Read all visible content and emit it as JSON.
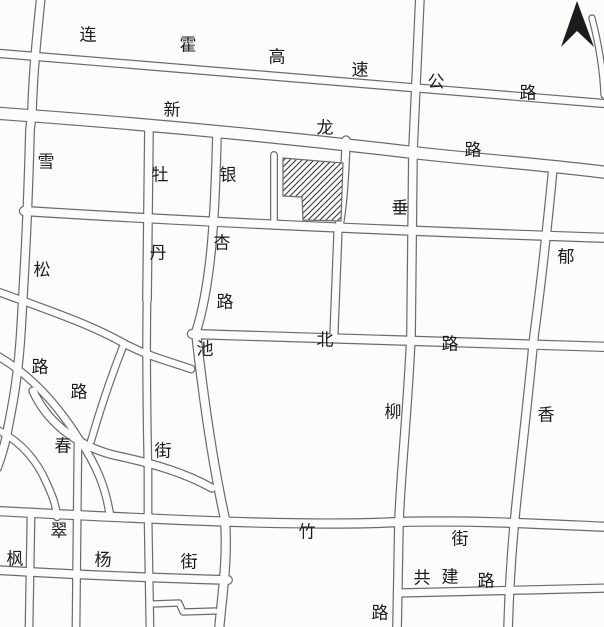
{
  "map": {
    "type": "scanned-planning-sketch",
    "colors": {
      "paper": "#fcfcfa",
      "line": "#6b6b6b",
      "ink": "#1c1c1c",
      "site_fill": "#fcfcfa",
      "hatch_line": "#3a3a3a"
    },
    "north_arrow": {
      "present": true
    },
    "site_marker": {
      "style": "diagonal-hatch-parcel",
      "notch": "bottom-left"
    },
    "roads": [
      {
        "id": "lianhuo-expressway",
        "name": "连霍高速公路",
        "labels": [
          {
            "text": "连",
            "x": 88,
            "y": 35
          },
          {
            "text": "霍",
            "x": 188,
            "y": 45
          },
          {
            "text": "高",
            "x": 277,
            "y": 57
          },
          {
            "text": "速",
            "x": 360,
            "y": 70
          },
          {
            "text": "公",
            "x": 436,
            "y": 82
          },
          {
            "text": "路",
            "x": 528,
            "y": 93
          }
        ]
      },
      {
        "id": "xinlong-road",
        "name": "新龙路",
        "labels": [
          {
            "text": "新",
            "x": 172,
            "y": 110
          },
          {
            "text": "龙",
            "x": 325,
            "y": 128
          },
          {
            "text": "路",
            "x": 473,
            "y": 150
          }
        ]
      },
      {
        "id": "xuesong-road",
        "name": "雪松路",
        "labels": [
          {
            "text": "雪",
            "x": 46,
            "y": 162
          },
          {
            "text": "松",
            "x": 42,
            "y": 270
          }
        ]
      },
      {
        "id": "mudan-road",
        "name": "牡丹路",
        "labels": [
          {
            "text": "牡",
            "x": 160,
            "y": 175
          },
          {
            "text": "丹",
            "x": 158,
            "y": 253
          }
        ]
      },
      {
        "id": "yinxing-road",
        "name": "银杏路",
        "labels": [
          {
            "text": "银",
            "x": 228,
            "y": 175
          },
          {
            "text": "杏",
            "x": 222,
            "y": 243
          },
          {
            "text": "路",
            "x": 225,
            "y": 302
          }
        ]
      },
      {
        "id": "chuiliu-road",
        "name": "垂柳路",
        "labels": [
          {
            "text": "垂",
            "x": 400,
            "y": 208
          },
          {
            "text": "柳",
            "x": 393,
            "y": 412
          }
        ]
      },
      {
        "id": "yuxiang-road",
        "name": "郁香路",
        "labels": [
          {
            "text": "郁",
            "x": 566,
            "y": 257
          },
          {
            "text": "香",
            "x": 546,
            "y": 415
          }
        ]
      },
      {
        "id": "chibei-road",
        "name": "池北路",
        "labels": [
          {
            "text": "池",
            "x": 205,
            "y": 349
          },
          {
            "text": "北",
            "x": 325,
            "y": 340
          },
          {
            "text": "路",
            "x": 450,
            "y": 344
          }
        ]
      },
      {
        "id": "chun-street",
        "name": "春街",
        "labels": [
          {
            "text": "春",
            "x": 63,
            "y": 446
          },
          {
            "text": "街",
            "x": 163,
            "y": 451
          }
        ]
      },
      {
        "id": "cuizhu-street",
        "name": "翠竹街",
        "labels": [
          {
            "text": "翠",
            "x": 59,
            "y": 531
          },
          {
            "text": "竹",
            "x": 307,
            "y": 532
          },
          {
            "text": "街",
            "x": 460,
            "y": 539
          }
        ]
      },
      {
        "id": "fengyang-street",
        "name": "枫杨街",
        "labels": [
          {
            "text": "枫",
            "x": 15,
            "y": 559
          },
          {
            "text": "杨",
            "x": 103,
            "y": 560
          },
          {
            "text": "街",
            "x": 189,
            "y": 562
          }
        ]
      },
      {
        "id": "gongjian-road",
        "name": "共建路",
        "labels": [
          {
            "text": "共",
            "x": 422,
            "y": 578
          },
          {
            "text": "建",
            "x": 450,
            "y": 577
          },
          {
            "text": "路",
            "x": 486,
            "y": 581
          }
        ]
      }
    ],
    "other_labels": [
      {
        "text": "路",
        "x": 40,
        "y": 367
      },
      {
        "text": "路",
        "x": 79,
        "y": 392
      },
      {
        "text": "路",
        "x": 380,
        "y": 613
      }
    ],
    "label_font_px": 17
  }
}
